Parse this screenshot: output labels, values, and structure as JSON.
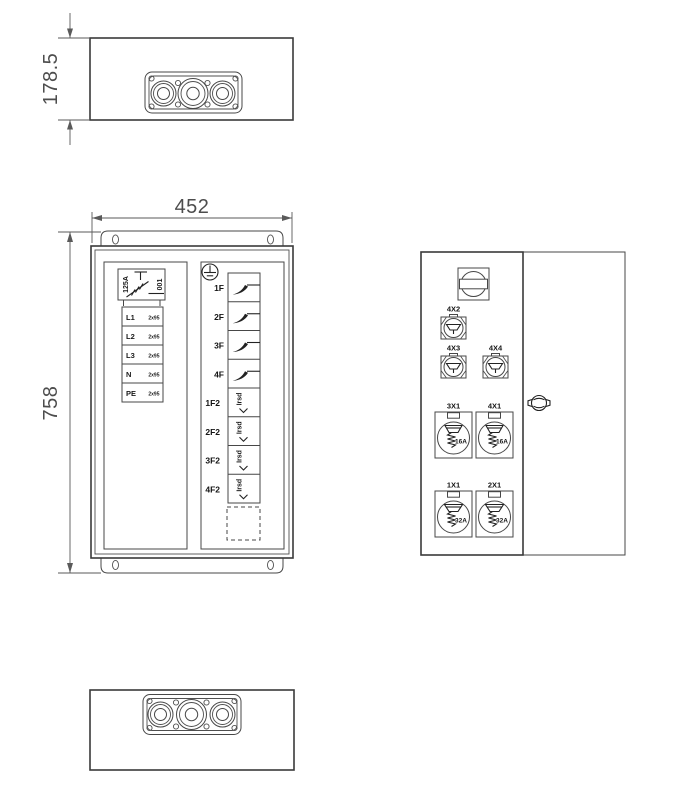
{
  "dims": {
    "h_top": "178.5",
    "w_front": "452",
    "h_front": "758"
  },
  "front": {
    "switch_rating": "125A",
    "switch_code": "001",
    "terminals": [
      {
        "label": "L1",
        "spec": "2x95"
      },
      {
        "label": "L2",
        "spec": "2x95"
      },
      {
        "label": "L3",
        "spec": "2x95"
      },
      {
        "label": "N",
        "spec": "2x95"
      },
      {
        "label": "PE",
        "spec": "2x95"
      }
    ],
    "feeders": [
      {
        "label": "1F"
      },
      {
        "label": "2F"
      },
      {
        "label": "3F"
      },
      {
        "label": "4F"
      }
    ],
    "rcds": [
      {
        "label": "1F2",
        "text": "Irsd"
      },
      {
        "label": "2F2",
        "text": "Irsd"
      },
      {
        "label": "3F2",
        "text": "Irsd"
      },
      {
        "label": "4F2",
        "text": "Irsd"
      }
    ]
  },
  "side": {
    "small_sockets": [
      {
        "label": "4X2"
      },
      {
        "label": "4X3"
      },
      {
        "label": "4X4"
      }
    ],
    "large_sockets": [
      {
        "label": "3X1",
        "rating": "16A"
      },
      {
        "label": "4X1",
        "rating": "16A"
      },
      {
        "label": "1X1",
        "rating": "32A"
      },
      {
        "label": "2X1",
        "rating": "32A"
      }
    ]
  },
  "colors": {
    "line": "#474747",
    "dim_text": "#4d4d4d",
    "symbol": "#222222"
  }
}
